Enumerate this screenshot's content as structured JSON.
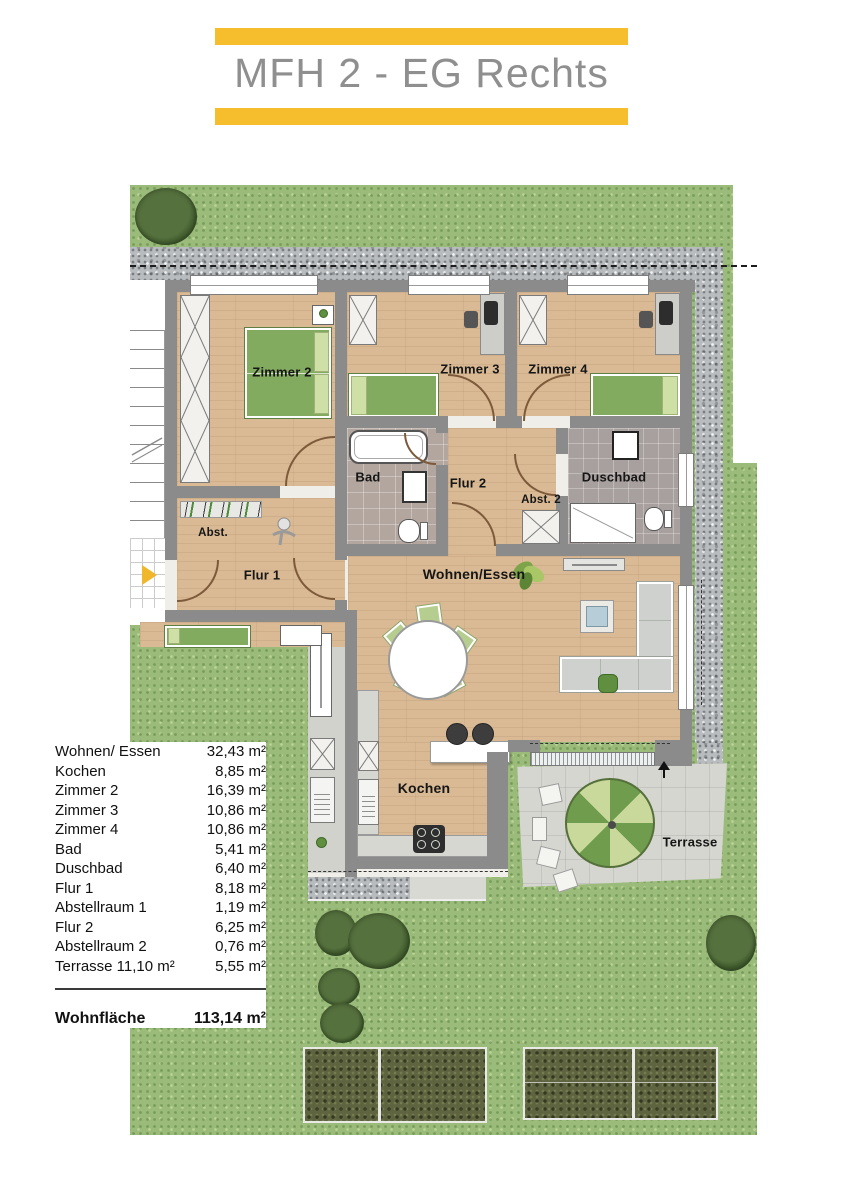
{
  "title": "MFH 2 - EG Rechts",
  "colors": {
    "accent_yellow": "#F6BE2C",
    "title_gray": "#8F8F8F",
    "wall_gray": "#8B8B8B",
    "grass_green": "#9ABB79",
    "wood_floor": "#D9BA95",
    "parasol_dark_green": "#6F9D4D",
    "parasol_light_green": "#C9D89B",
    "hedge_green": "#5E6340"
  },
  "rooms": {
    "zimmer2": "Zimmer 2",
    "zimmer3": "Zimmer 3",
    "zimmer4": "Zimmer 4",
    "bad": "Bad",
    "flur2": "Flur 2",
    "duschbad": "Duschbad",
    "abst2": "Abst. 2",
    "abst": "Abst.",
    "flur1": "Flur 1",
    "wohnen_essen": "Wohnen/Essen",
    "kochen": "Kochen",
    "terrasse": "Terrasse"
  },
  "area_table": {
    "rows": [
      {
        "label": "Wohnen/ Essen",
        "value": "32,43 m²"
      },
      {
        "label": "Kochen",
        "value": "8,85 m²"
      },
      {
        "label": "Zimmer 2",
        "value": "16,39 m²"
      },
      {
        "label": "Zimmer 3",
        "value": "10,86 m²"
      },
      {
        "label": "Zimmer 4",
        "value": "10,86 m²"
      },
      {
        "label": "Bad",
        "value": "5,41 m²"
      },
      {
        "label": "Duschbad",
        "value": "6,40 m²"
      },
      {
        "label": "Flur 1",
        "value": "8,18 m²"
      },
      {
        "label": "Abstellraum 1",
        "value": "1,19 m²"
      },
      {
        "label": "Flur 2",
        "value": "6,25 m²"
      },
      {
        "label": "Abstellraum 2",
        "value": "0,76 m²"
      },
      {
        "label": "Terrasse 11,10 m²",
        "value": "5,55 m²"
      }
    ],
    "total": {
      "label": "Wohnfläche",
      "value": "113,14 m²"
    }
  }
}
